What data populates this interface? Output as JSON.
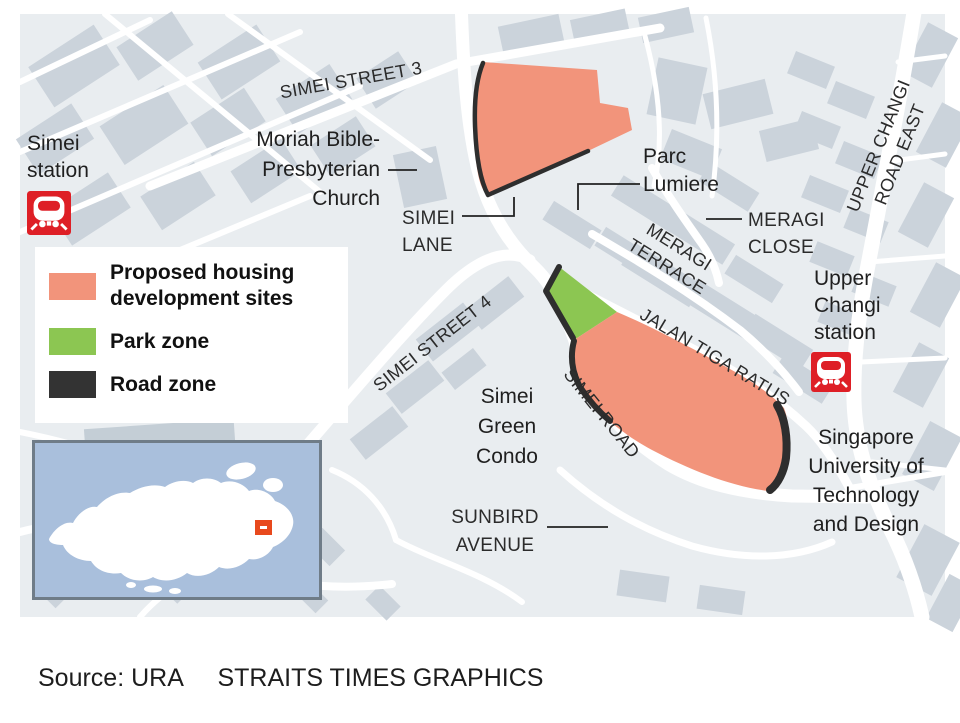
{
  "palette": {
    "housing": "#F2947B",
    "park": "#8CC652",
    "road_zone": "#2E2E2E",
    "legend_road_swatch": "#333333",
    "mrt_red": "#DE1F26",
    "inset_water": "#A9BFDC",
    "inset_marker": "#E8491D"
  },
  "legend": {
    "items": [
      {
        "label": "Proposed housing development sites",
        "color": "#F2947B"
      },
      {
        "label": "Park zone",
        "color": "#8CC652"
      },
      {
        "label": "Road zone",
        "color": "#333333"
      }
    ]
  },
  "map": {
    "road_labels": {
      "simei_street_3": "SIMEI STREET 3",
      "simei_lane": [
        "SIMEI",
        "LANE"
      ],
      "simei_street_4": "SIMEI STREET 4",
      "simei_road": "SIMEI ROAD",
      "jalan_tiga_ratus": "JALAN TIGA RATUS",
      "meragi_terrace": [
        "MERAGI",
        "TERRACE"
      ],
      "meragi_close": [
        "MERAGI",
        "CLOSE"
      ],
      "upper_changi_road_east": [
        "UPPER CHANGI",
        "ROAD EAST"
      ],
      "sunbird_avenue": [
        "SUNBIRD",
        "AVENUE"
      ]
    },
    "place_labels": {
      "simei_station": [
        "Simei",
        "station"
      ],
      "moriah_church": [
        "Moriah Bible-",
        "Presbyterian",
        "Church"
      ],
      "parc_lumiere": [
        "Parc",
        "Lumiere"
      ],
      "upper_changi_station": [
        "Upper",
        "Changi",
        "station"
      ],
      "simei_green_condo": [
        "Simei",
        "Green",
        "Condo"
      ],
      "sutd": [
        "Singapore",
        "University of",
        "Technology",
        "and Design"
      ]
    }
  },
  "footer": {
    "source_label": "Source: URA",
    "credit": "STRAITS TIMES GRAPHICS"
  }
}
